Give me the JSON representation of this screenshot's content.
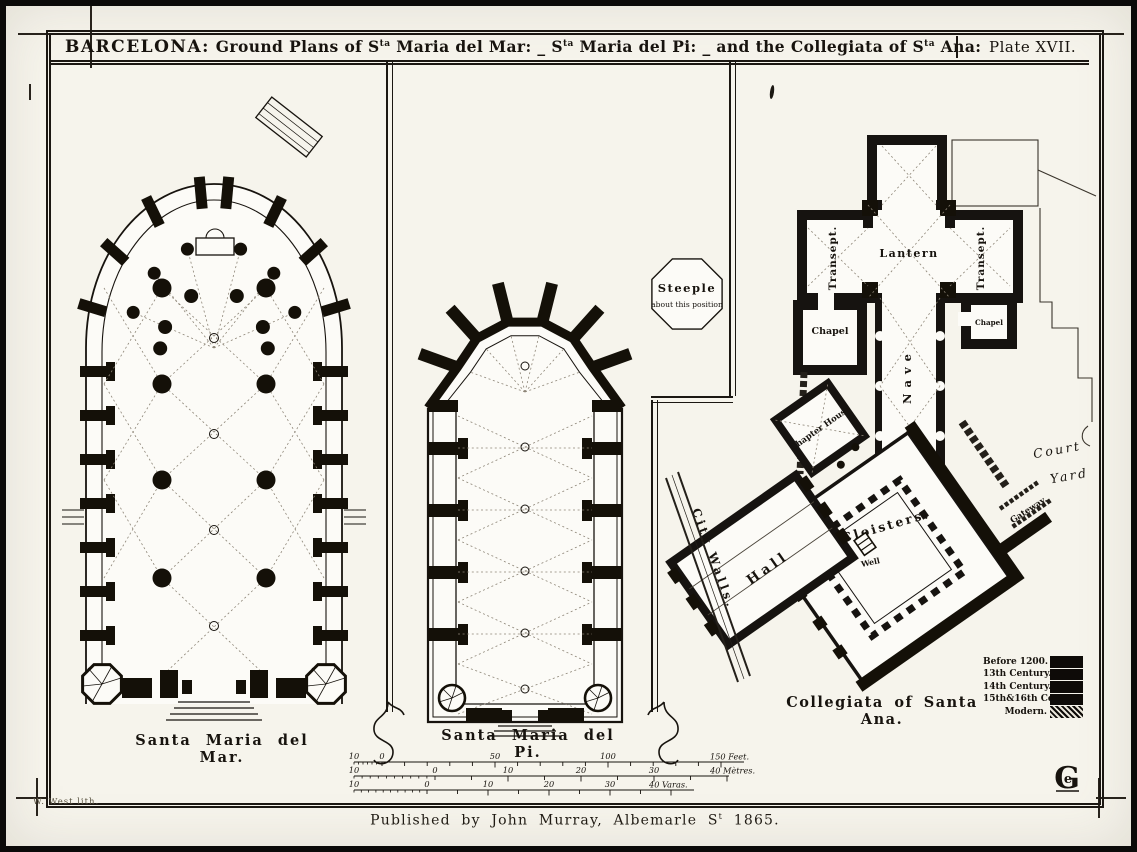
{
  "plate": {
    "title": {
      "city": "BARCELONA:",
      "p1": " Ground Plans of S",
      "s1": "ta",
      "p2": " Maria del Mar: _ S",
      "s2": "ta",
      "p3": " Maria del Pi: _ and the Collegiata of S",
      "s3": "ta",
      "p4": " Ana:",
      "plate_number": "Plate XVII."
    },
    "publisher": {
      "p1": "Published by John Murray, Albemarle S",
      "sup": "t",
      "p2": " 1865."
    },
    "lithographer": "W. West lith."
  },
  "plans": {
    "mar": {
      "caption": "Santa Maria del Mar."
    },
    "pi": {
      "caption": "Santa Maria del Pi."
    },
    "steeple_note": {
      "line1": "Steeple",
      "line2": "about this position"
    },
    "ana": {
      "caption": "Collegiata of Santa Ana.",
      "labels": {
        "transept_left": "Transept.",
        "lantern": "Lantern",
        "transept_right": "Transept.",
        "chapel_left": "Chapel",
        "chapel_right": "Chapel",
        "nave": "Nave",
        "chapter_house": "Chapter House",
        "court_line1": "Court",
        "court_line2": "Yard",
        "cloisters": "Cloisters.",
        "well": "Well",
        "gateway": "Gateway.",
        "hall": "Hall",
        "city_walls": "City Walls."
      }
    }
  },
  "legend": {
    "items": [
      {
        "label": "Before 1200.",
        "swatch": "solid"
      },
      {
        "label": "13th Century.",
        "swatch": "solid"
      },
      {
        "label": "14th Century.",
        "swatch": "solid"
      },
      {
        "label": "15th&16th Centy",
        "swatch": "solid"
      },
      {
        "label": "Modern.",
        "swatch": "hatch"
      }
    ]
  },
  "scale_bars": [
    {
      "numbers": [
        "10",
        "0",
        "50",
        "100"
      ],
      "end_label": "150 Feet."
    },
    {
      "numbers": [
        "10",
        "0",
        "10",
        "20",
        "30"
      ],
      "end_label": "40 Mètres."
    },
    {
      "numbers": [
        "10",
        "0",
        "10",
        "20",
        "30"
      ],
      "end_label": "40 Varas."
    }
  ],
  "colors": {
    "ink": "#17130e",
    "paper": "#f6f4ec"
  }
}
